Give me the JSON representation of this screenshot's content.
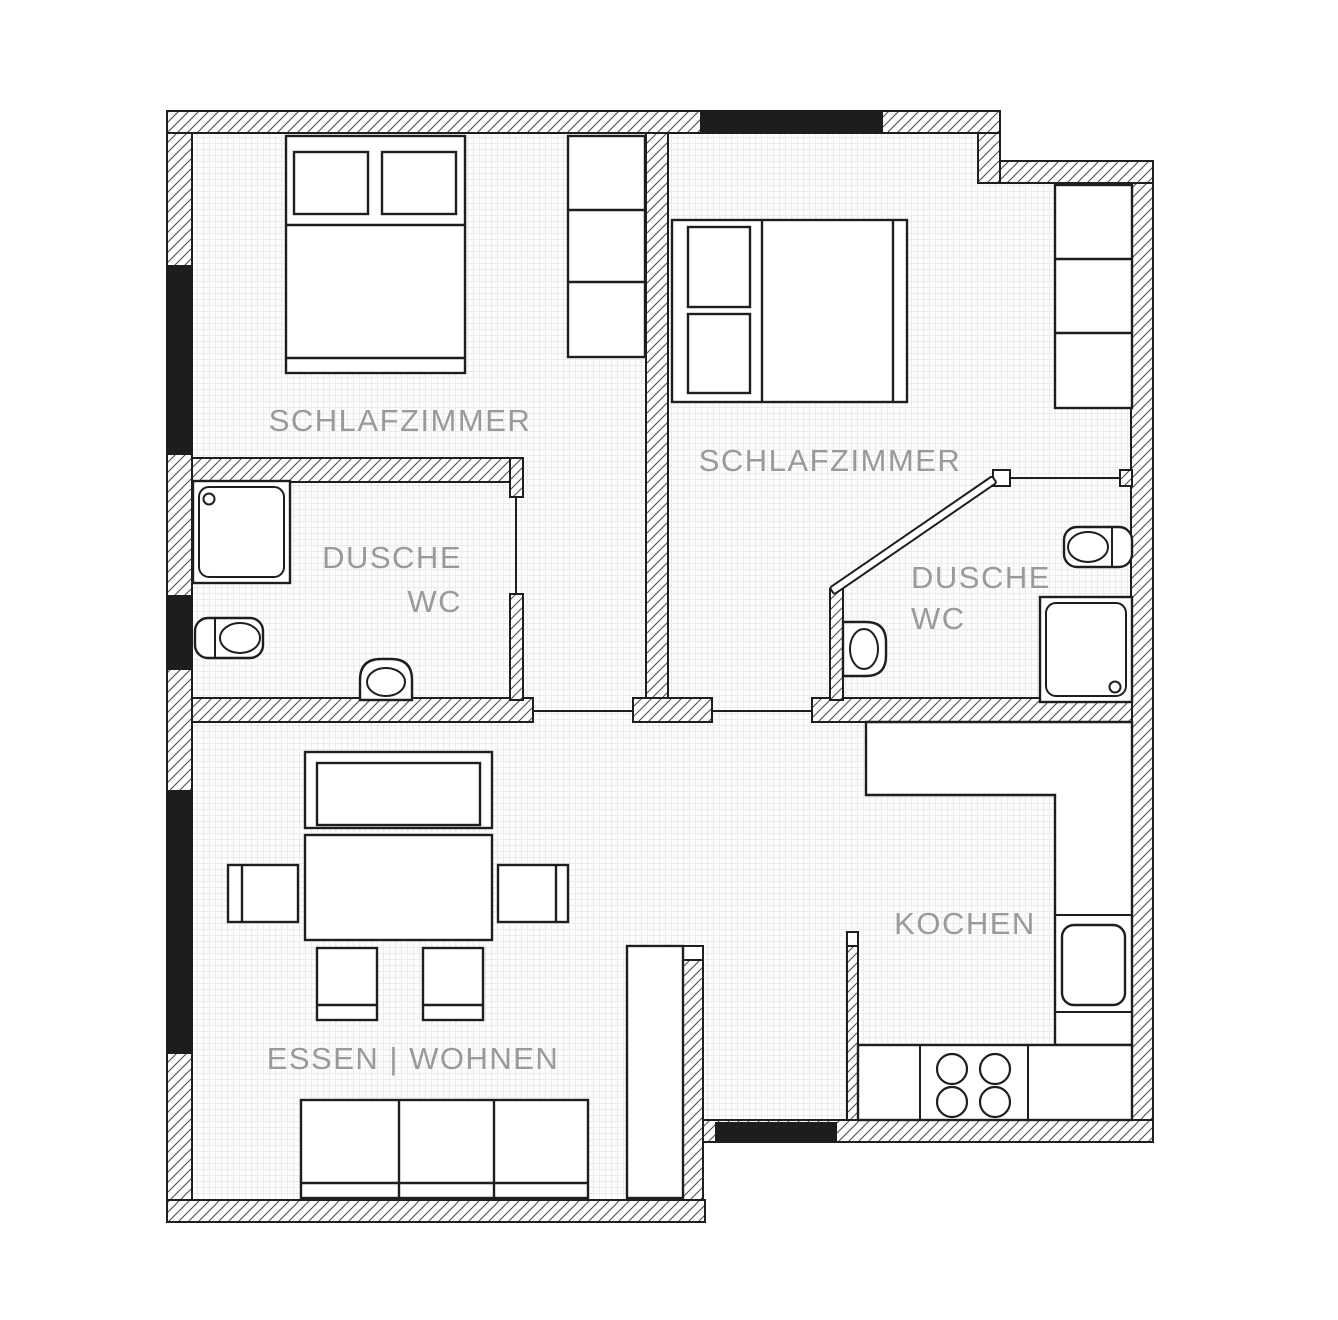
{
  "plan": {
    "title": "apartment-floor-plan",
    "labels": {
      "bedroom_left": "SCHLAFZIMMER",
      "bedroom_right": "SCHLAFZIMMER",
      "bath_left_line1": "DUSCHE",
      "bath_left_line2": "WC",
      "bath_right_line1": "DUSCHE",
      "bath_right_line2": "WC",
      "kitchen": "KOCHEN",
      "living": "ESSEN | WOHNEN"
    },
    "colors": {
      "outline": "#1e1e1e",
      "hatch_line": "#4f4f4f",
      "window_fill": "#1d1d1d",
      "label_text": "#9a9a9a",
      "floor_fill": "#fdfdfd",
      "grid_line": "#ebebeb",
      "background": "#ffffff"
    }
  }
}
